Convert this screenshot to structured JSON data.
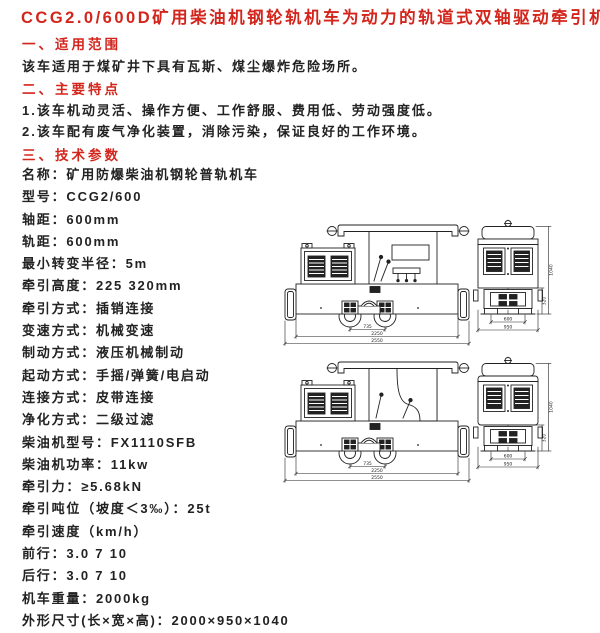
{
  "page": {
    "title": "CCG2.0/600D矿用柴油机钢轮轨机车为动力的轨道式双轴驱动牵引机车",
    "accent_color": "#d3251c",
    "text_color": "#222222",
    "background_color": "#ffffff"
  },
  "sections": {
    "scope": {
      "heading": "一、适用范围",
      "body": "该车适用于煤矿井下具有瓦斯、煤尘爆炸危险场所。"
    },
    "features": {
      "heading": "二、主要特点",
      "items": [
        "1.该车机动灵活、操作方便、工作舒服、费用低、劳动强度低。",
        "2.该车配有废气净化装置，消除污染，保证良好的工作环境。"
      ]
    },
    "specs": {
      "heading": "三、技术参数"
    }
  },
  "specs": [
    "名称：矿用防爆柴油机钢轮普轨机车",
    "型号：CCG2/600",
    "轴距：600mm",
    "轨距：600mm",
    "最小转变半径：5m",
    "牵引高度：225 320mm",
    "牵引方式：插销连接",
    "变速方式：机械变速",
    "制动方式：液压机械制动",
    "起动方式：手摇/弹簧/电启动",
    "连接方式：皮带连接",
    "净化方式：二级过滤",
    "柴油机型号：FX1110SFB",
    "柴油机功率：11kw",
    "牵引力：≥5.68kN",
    "牵引吨位（坡度＜3‰）：25t",
    "牵引速度（km/h）",
    "前行：3.0  7  10",
    "后行：3.0  7  10",
    "机车重量：2000kg",
    "外形尺寸(长×宽×高)：2000×950×1040"
  ],
  "figures": {
    "dims": {
      "wheelbase": "735",
      "frame_length": "2250",
      "overall_length": "2550",
      "gauge": "600",
      "width": "950",
      "height": "1040",
      "coupler_height": "320"
    }
  }
}
